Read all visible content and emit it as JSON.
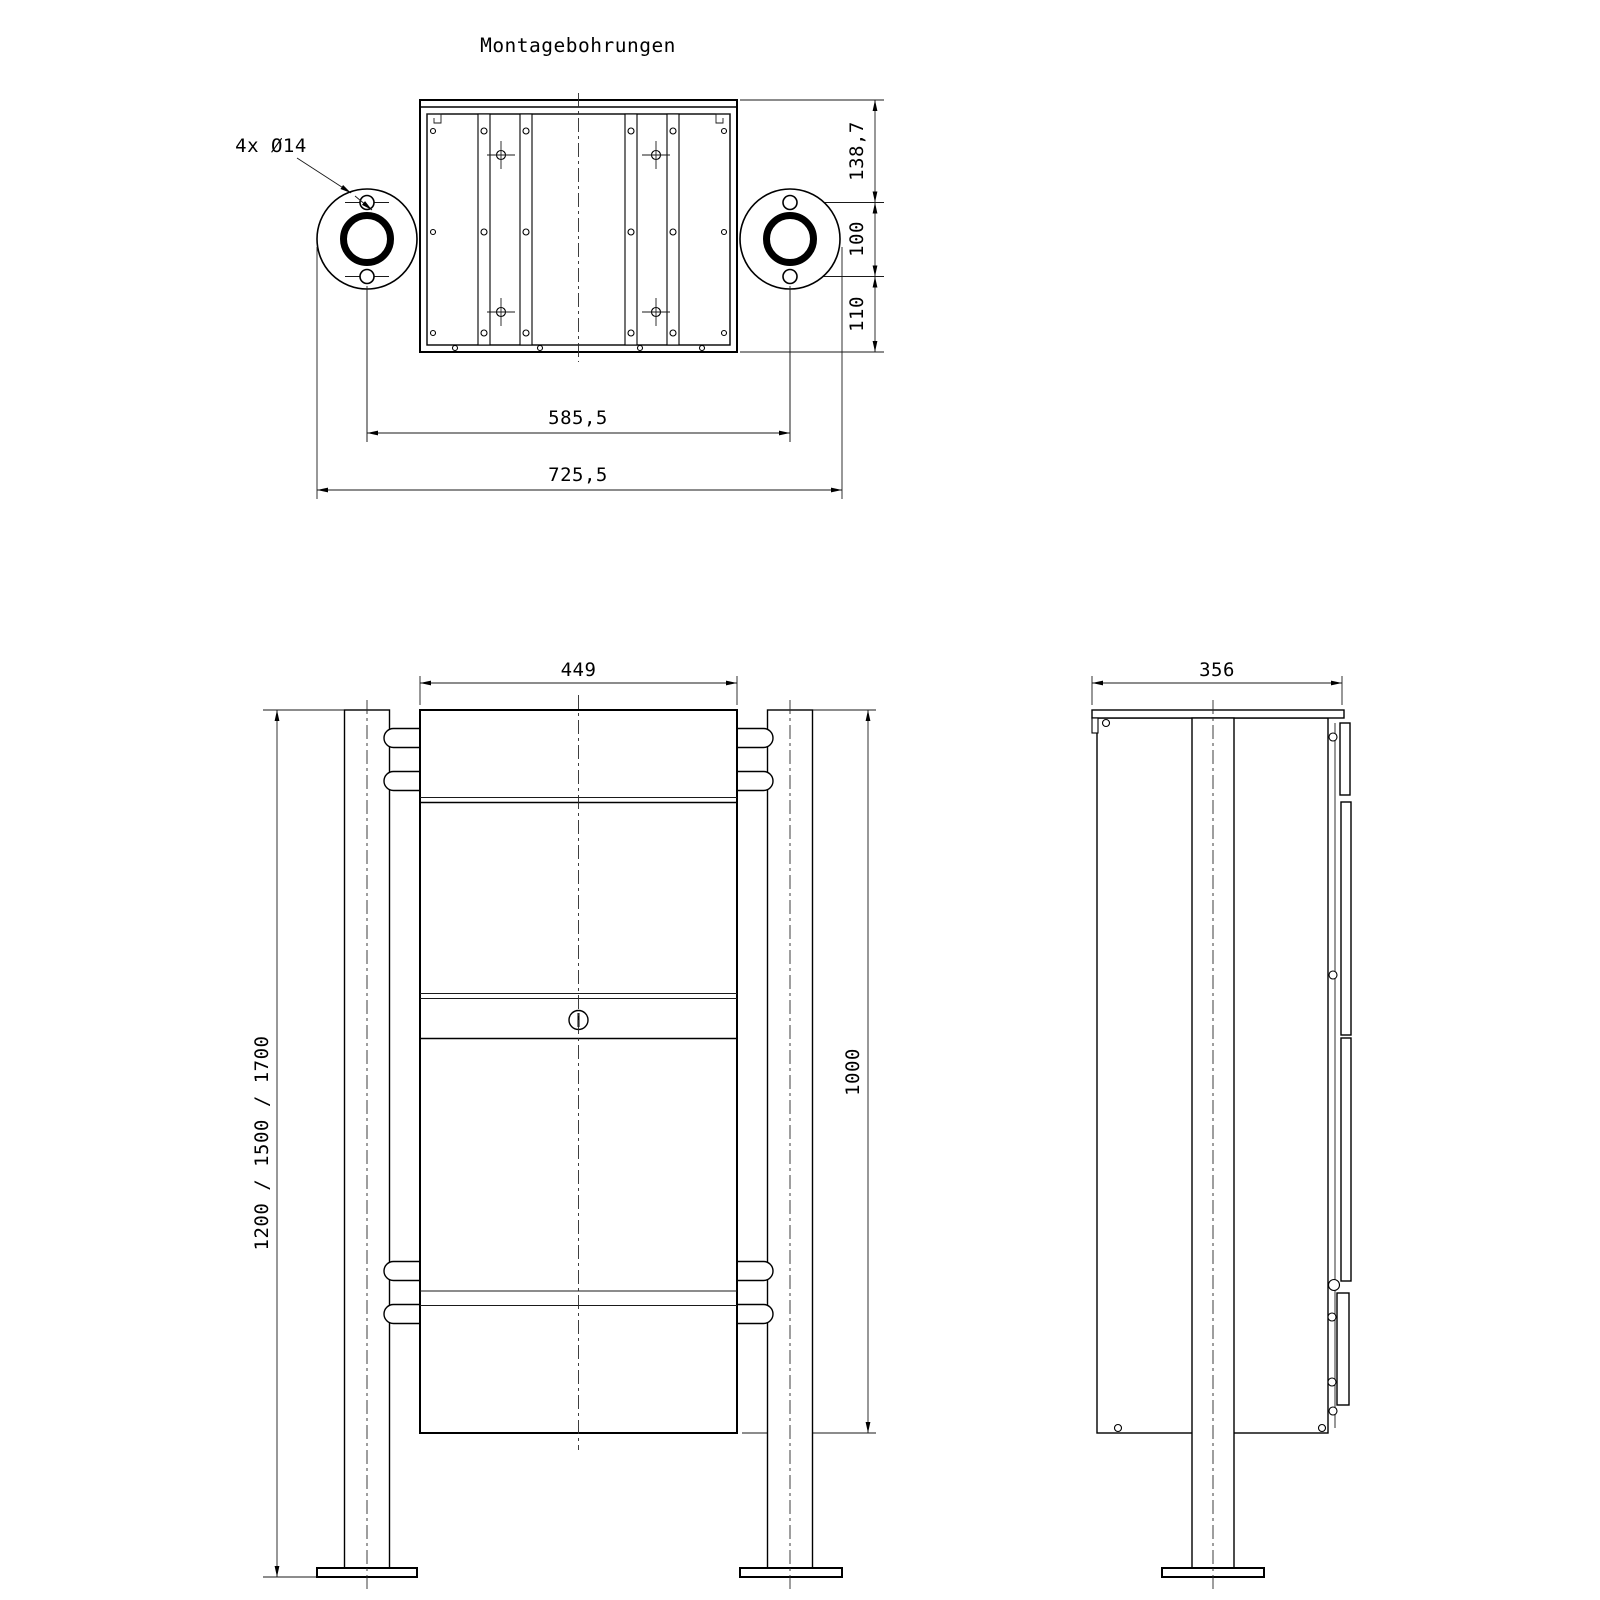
{
  "title": "Montagebohrungen",
  "top_view": {
    "holes_label": "4x Ø14",
    "dim_top_offset": "138,7",
    "dim_hole_spacing_vertical": "100",
    "dim_bottom_offset": "110",
    "dim_hole_spacing_horizontal": "585,5",
    "dim_overall_width": "725,5"
  },
  "front_view": {
    "dim_box_width": "449",
    "dim_post_heights": "1200 / 1500 / 1700",
    "dim_box_height": "1000"
  },
  "side_view": {
    "dim_depth": "356"
  },
  "colors": {
    "line": "#000000",
    "background": "#ffffff"
  }
}
